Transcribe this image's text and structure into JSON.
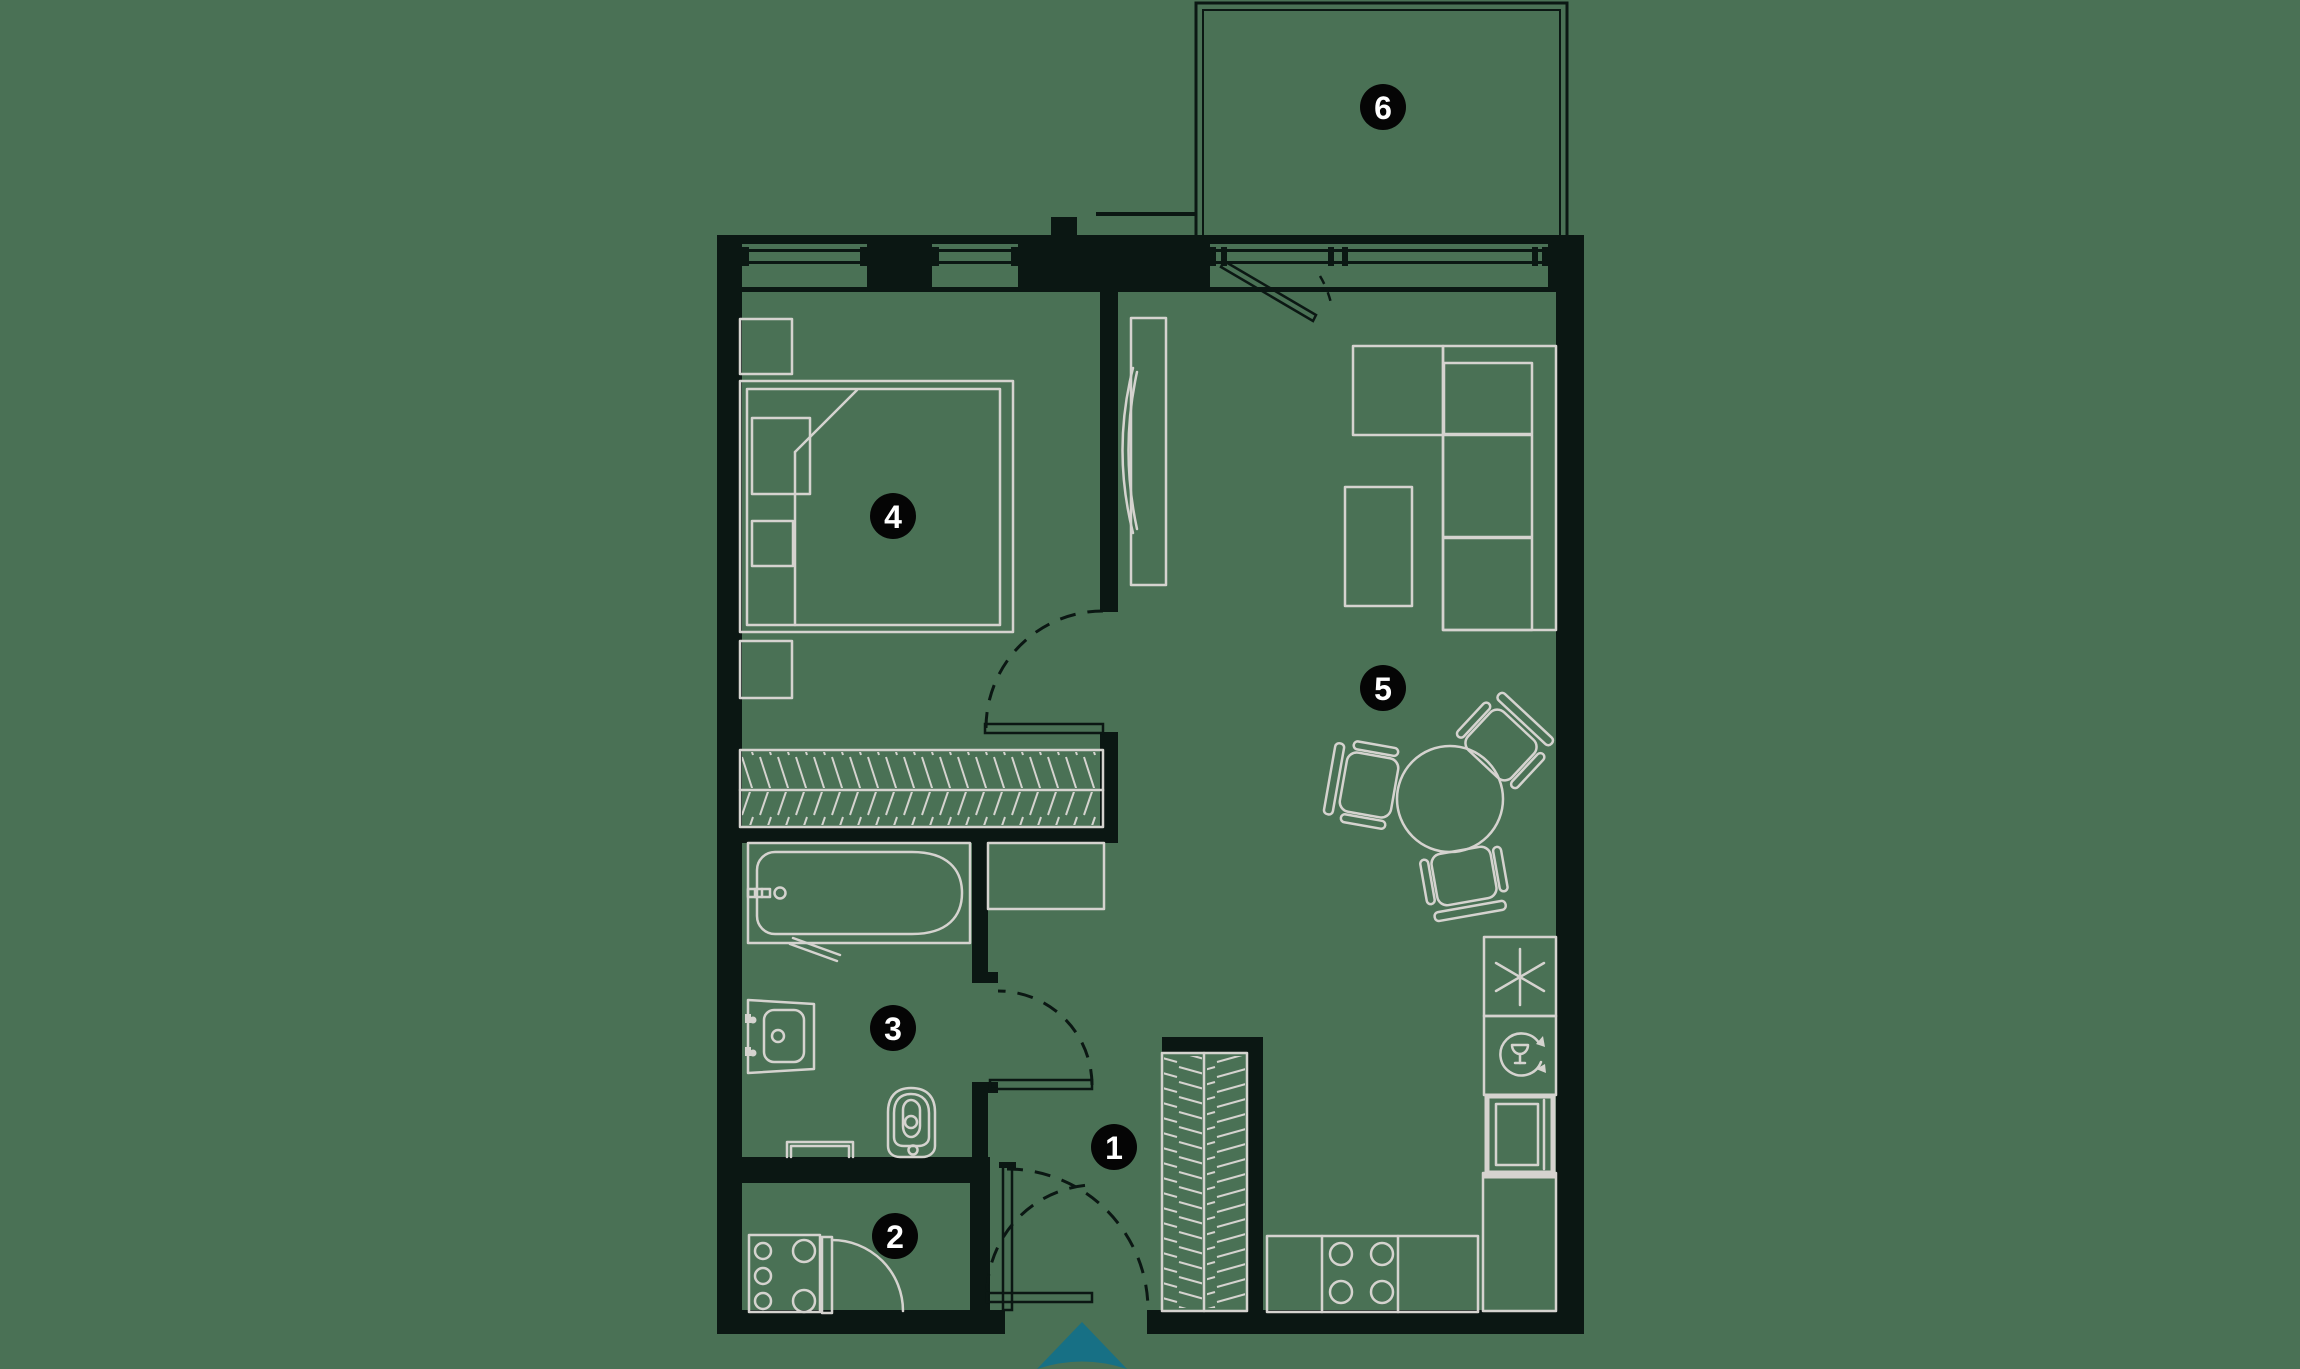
{
  "title": "Apartment floor plan",
  "colors": {
    "background": "#4a7155",
    "walls": "#0b1713",
    "furniture": "#d5d3cf",
    "marker_bg": "#050505",
    "marker_text": "#ffffff",
    "arrow": "#177085"
  },
  "markers": [
    {
      "label": "1",
      "room": "hallway"
    },
    {
      "label": "2",
      "room": "utility-room"
    },
    {
      "label": "3",
      "room": "bathroom"
    },
    {
      "label": "4",
      "room": "bedroom"
    },
    {
      "label": "5",
      "room": "living-room-kitchen"
    },
    {
      "label": "6",
      "room": "balcony"
    }
  ]
}
